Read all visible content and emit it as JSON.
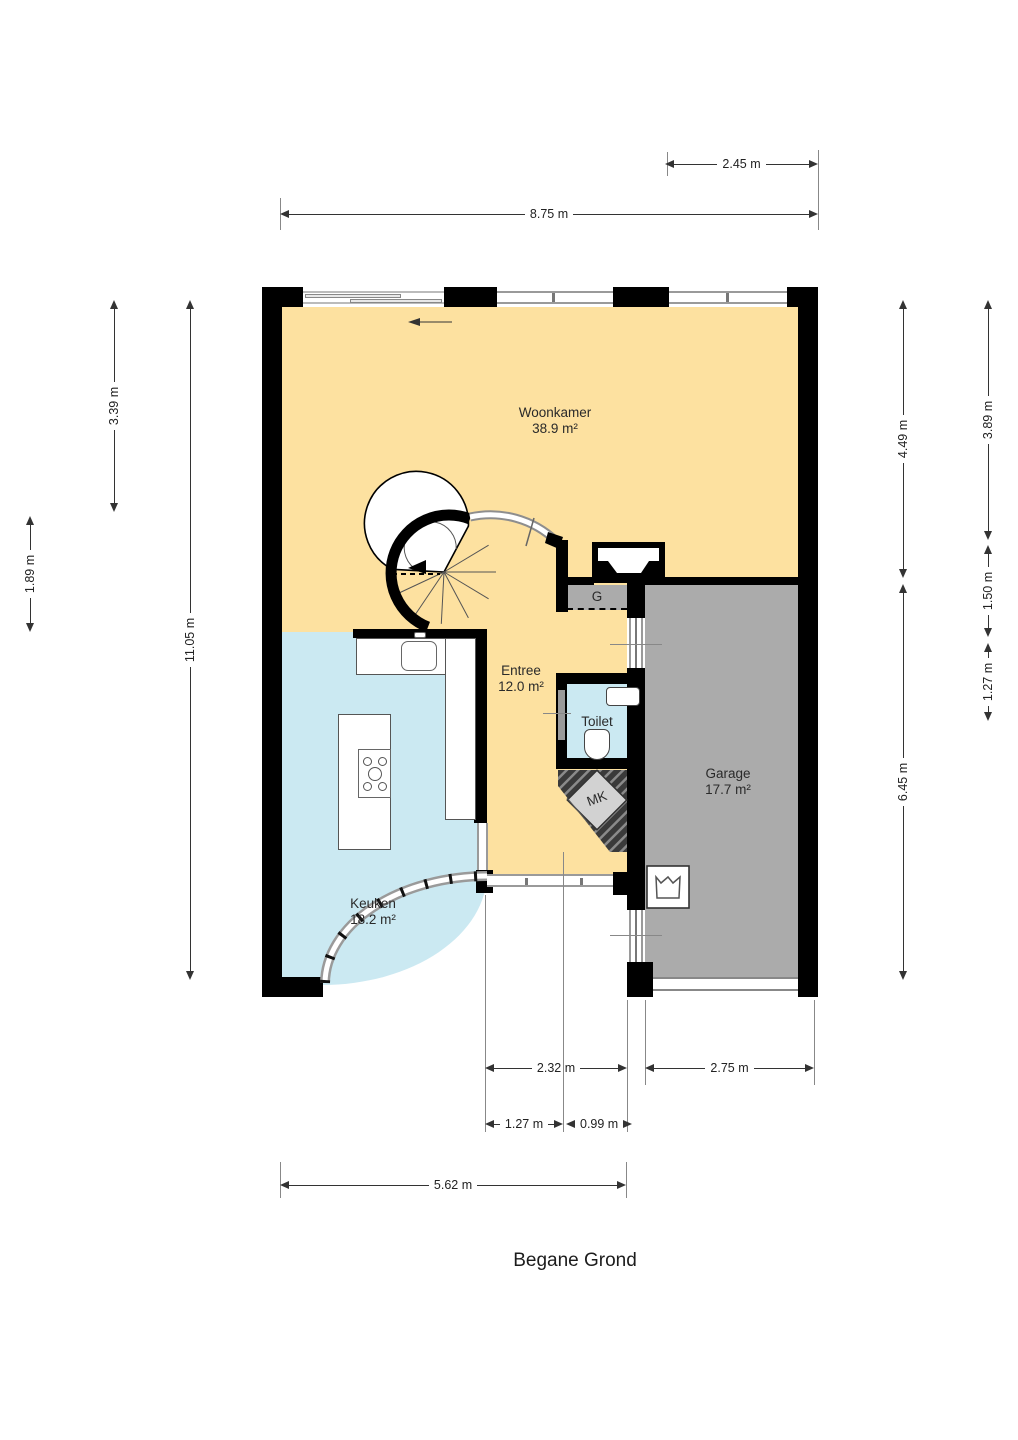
{
  "title": "Begane Grond",
  "rooms": {
    "woonkamer": {
      "name": "Woonkamer",
      "area": "38.9 m²"
    },
    "entree": {
      "name": "Entree",
      "area": "12.0 m²"
    },
    "keuken": {
      "name": "Keuken",
      "area": "18.2 m²"
    },
    "garage": {
      "name": "Garage",
      "area": "17.7 m²"
    },
    "toilet": {
      "name": "Toilet"
    },
    "g": {
      "name": "G"
    },
    "mk": {
      "name": "MK"
    }
  },
  "dims": {
    "top_garage_width": "2.45 m",
    "top_full_width": "8.75 m",
    "left_upper": "3.39 m",
    "left_mid": "1.89 m",
    "left_full": "11.05 m",
    "right_upper": "4.49 m",
    "right_upper_inner": "3.89 m",
    "right_mid_inner": "1.50 m",
    "right_lower_inner": "1.27 m",
    "right_lower": "6.45 m",
    "bottom_entree": "2.32 m",
    "bottom_garage": "2.75 m",
    "bottom_small_left": "1.27 m",
    "bottom_small_right": "0.99 m",
    "bottom_full": "5.62 m"
  },
  "colors": {
    "wall": "#000000",
    "living": "#FDE1A0",
    "kitchen": "#CBE9F2",
    "garage": "#ABABAB",
    "glass": "#9a9a9a"
  }
}
